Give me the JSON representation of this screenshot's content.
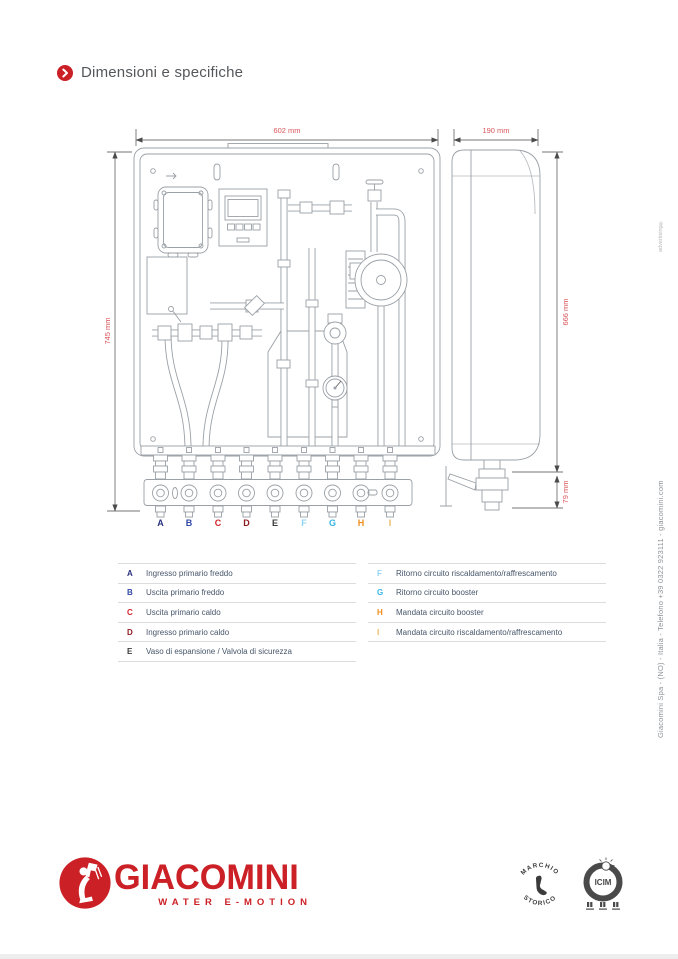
{
  "page": {
    "title": "Dimensioni e specifiche"
  },
  "drawing": {
    "dims": {
      "front_width": "602 mm",
      "side_depth": "190 mm",
      "front_height": "745 mm",
      "side_height": "666 mm",
      "side_connection_height": "79 mm"
    },
    "connections": [
      {
        "letter": "A",
        "color": "#282f7e"
      },
      {
        "letter": "B",
        "color": "#3347a5"
      },
      {
        "letter": "C",
        "color": "#d2232a"
      },
      {
        "letter": "D",
        "color": "#8f1d22"
      },
      {
        "letter": "E",
        "color": "#3a3a39"
      },
      {
        "letter": "F",
        "color": "#8ed4f2"
      },
      {
        "letter": "G",
        "color": "#36b5e5"
      },
      {
        "letter": "H",
        "color": "#ef8f1e"
      },
      {
        "letter": "I",
        "color": "#e8b861"
      }
    ]
  },
  "legend": {
    "left": [
      {
        "letter": "A",
        "color": "#282f7e",
        "text": "Ingresso primario freddo"
      },
      {
        "letter": "B",
        "color": "#3347a5",
        "text": "Uscita primario freddo"
      },
      {
        "letter": "C",
        "color": "#d2232a",
        "text": "Uscita primario caldo"
      },
      {
        "letter": "D",
        "color": "#8f1d22",
        "text": "Ingresso primario caldo"
      },
      {
        "letter": "E",
        "color": "#3a3a39",
        "text": "Vaso di espansione / Valvola di sicurezza"
      }
    ],
    "right": [
      {
        "letter": "F",
        "color": "#8ed4f2",
        "text": "Ritorno circuito riscaldamento/raffrescamento"
      },
      {
        "letter": "G",
        "color": "#36b5e5",
        "text": "Ritorno circuito booster"
      },
      {
        "letter": "H",
        "color": "#ef8f1e",
        "text": "Mandata circuito booster"
      },
      {
        "letter": "I",
        "color": "#e8b861",
        "text": "Mandata circuito riscaldamento/raffrescamento"
      }
    ]
  },
  "footer": {
    "brand": "GIACOMINI",
    "tagline": "WATER E-MOTION",
    "badges": {
      "marchio_top": "MARCHIO",
      "marchio_bottom": "STORICO",
      "icim": "ICIM"
    }
  },
  "side_texts": {
    "company": "Giacomini Spa - (NO) - Italia - Telefono +39 0322 923111 - giacomini.com",
    "watermark": "advertising®"
  },
  "colors": {
    "brand_red": "#cc2027",
    "dimension_red": "#d9565b",
    "title_gray": "#55585b",
    "legend_text": "#47566a",
    "line_gray": "#9aa0a6"
  }
}
